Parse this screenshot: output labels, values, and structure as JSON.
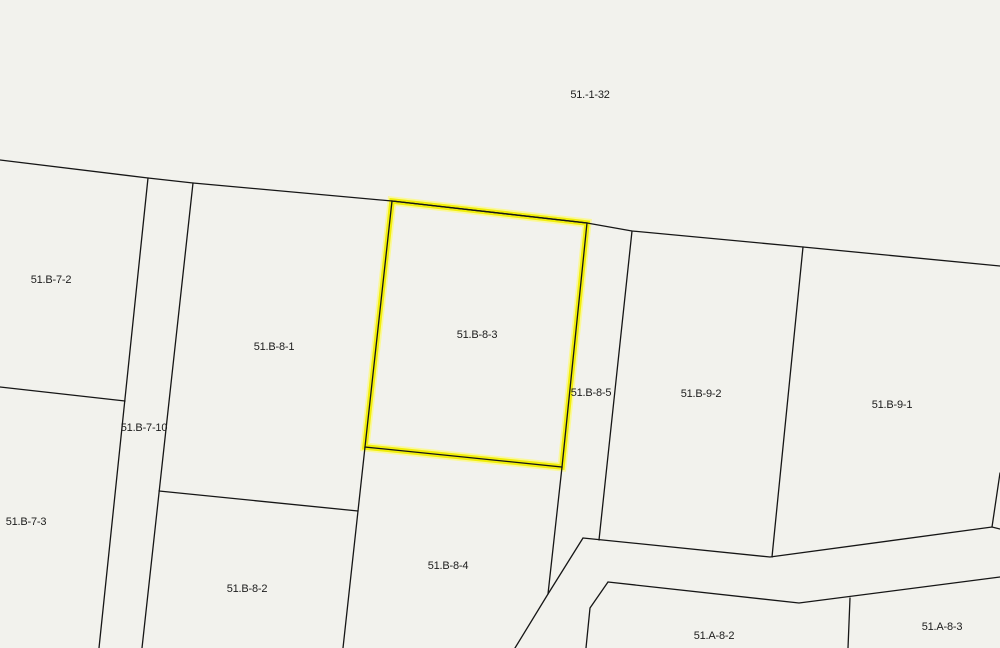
{
  "map": {
    "type": "cadastral-parcel-map",
    "background_color": "#f2f2ed",
    "boundary_color": "#161616",
    "highlight_color": "#f1ee0b",
    "highlight_halo_color": "#fbf98c",
    "label_color": "#1c1c1c",
    "highlighted_parcel": "51.B-8-3",
    "parcels": [
      {
        "label": "51.-1-32"
      },
      {
        "label": "51.B-7-2"
      },
      {
        "label": "51.B-8-1"
      },
      {
        "label": "51.B-8-3"
      },
      {
        "label": "51.B-8-5"
      },
      {
        "label": "51.B-9-2"
      },
      {
        "label": "51.B-9-1"
      },
      {
        "label": "51.B-7-10"
      },
      {
        "label": "51.B-7-3"
      },
      {
        "label": "51.B-8-2"
      },
      {
        "label": "51.B-8-4"
      },
      {
        "label": "51.A-8-2"
      },
      {
        "label": "51.A-8-3"
      }
    ]
  }
}
